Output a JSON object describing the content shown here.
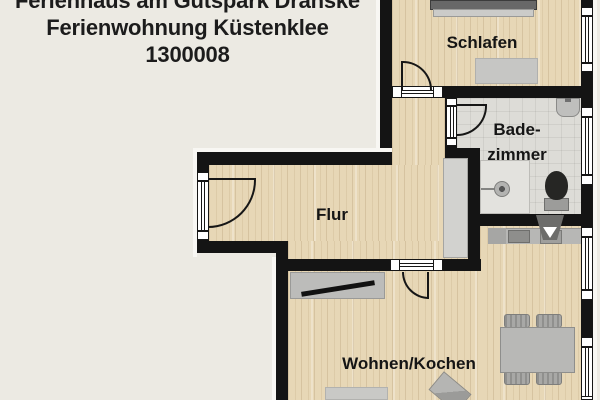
{
  "header": {
    "line1": "Ferienhaus am Gutspark Dranske",
    "line2": "Ferienwohnung Küstenklee",
    "line3": "1300008"
  },
  "rooms": {
    "bedroom": {
      "label": "Schlafen"
    },
    "bathroom": {
      "line1": "Bade-",
      "line2": "zimmer"
    },
    "hallway": {
      "label": "Flur"
    },
    "living": {
      "label": "Wohnen/Kochen"
    }
  },
  "symbols": {
    "door": "quarter-circle-swing",
    "window": "triple-line-glazing",
    "toilet": "black-oval-with-cistern",
    "shower": "shower-head-circle",
    "tv": "diagonal-black-bar",
    "extractor_hood": "funnel-triangle"
  },
  "colors": {
    "background": "#eceae3",
    "wall": "#141414",
    "wood_floor": "#e7d7b6",
    "tile_floor": "#dddcd7",
    "furniture_gray": "#bdbdbb",
    "text": "#1a1a1a",
    "frame_white": "#ffffff"
  }
}
